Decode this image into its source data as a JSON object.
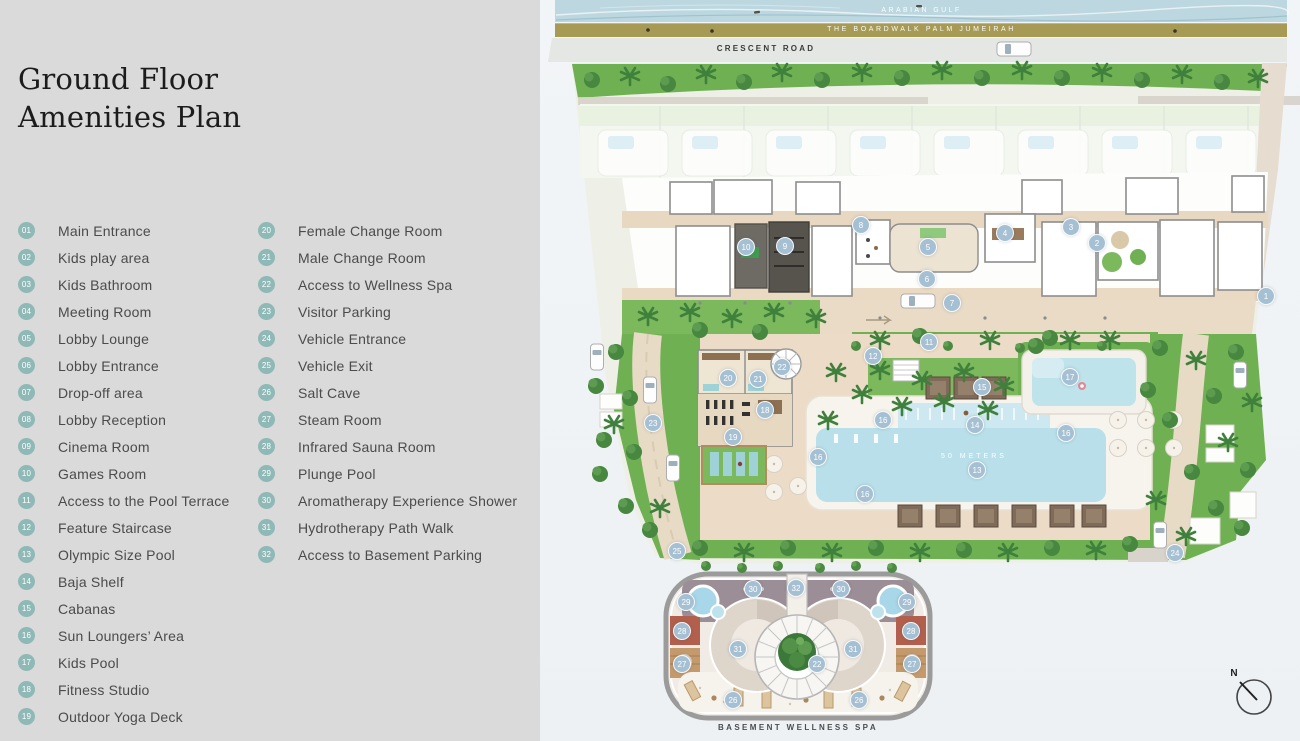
{
  "title": {
    "line1": "Ground Floor",
    "line2": "Amenities Plan"
  },
  "legend": {
    "column1": [
      {
        "num": "01",
        "label": "Main Entrance"
      },
      {
        "num": "02",
        "label": "Kids play area"
      },
      {
        "num": "03",
        "label": "Kids Bathroom"
      },
      {
        "num": "04",
        "label": "Meeting Room"
      },
      {
        "num": "05",
        "label": "Lobby Lounge"
      },
      {
        "num": "06",
        "label": "Lobby Entrance"
      },
      {
        "num": "07",
        "label": "Drop-off area"
      },
      {
        "num": "08",
        "label": "Lobby Reception"
      },
      {
        "num": "09",
        "label": "Cinema Room"
      },
      {
        "num": "10",
        "label": "Games Room"
      },
      {
        "num": "11",
        "label": "Access to the Pool Terrace"
      },
      {
        "num": "12",
        "label": "Feature Staircase"
      },
      {
        "num": "13",
        "label": "Olympic Size Pool"
      },
      {
        "num": "14",
        "label": "Baja Shelf"
      },
      {
        "num": "15",
        "label": "Cabanas"
      },
      {
        "num": "16",
        "label": "Sun Loungers’ Area"
      },
      {
        "num": "17",
        "label": "Kids Pool"
      },
      {
        "num": "18",
        "label": "Fitness Studio"
      },
      {
        "num": "19",
        "label": "Outdoor Yoga Deck"
      }
    ],
    "column2": [
      {
        "num": "20",
        "label": "Female Change Room"
      },
      {
        "num": "21",
        "label": "Male Change Room"
      },
      {
        "num": "22",
        "label": "Access to Wellness Spa"
      },
      {
        "num": "23",
        "label": "Visitor Parking"
      },
      {
        "num": "24",
        "label": "Vehicle Entrance"
      },
      {
        "num": "25",
        "label": "Vehicle Exit"
      },
      {
        "num": "26",
        "label": "Salt Cave"
      },
      {
        "num": "27",
        "label": "Steam Room"
      },
      {
        "num": "28",
        "label": "Infrared Sauna Room"
      },
      {
        "num": "29",
        "label": "Plunge Pool"
      },
      {
        "num": "30",
        "label": "Aromatherapy Experience Shower"
      },
      {
        "num": "31",
        "label": "Hydrotherapy Path Walk"
      },
      {
        "num": "32",
        "label": "Access to Basement Parking"
      }
    ]
  },
  "map": {
    "labels": {
      "gulf": "ARABIAN GULF",
      "boardwalk": "THE BOARDWALK PALM JUMEIRAH",
      "road": "CRESCENT ROAD",
      "pool": "50 METERS",
      "spa": "BASEMENT WELLNESS SPA",
      "compass": "N"
    },
    "markers": [
      {
        "n": "1",
        "x": 1266,
        "y": 296
      },
      {
        "n": "2",
        "x": 1097,
        "y": 243
      },
      {
        "n": "3",
        "x": 1071,
        "y": 227
      },
      {
        "n": "4",
        "x": 1005,
        "y": 233
      },
      {
        "n": "5",
        "x": 928,
        "y": 247
      },
      {
        "n": "6",
        "x": 927,
        "y": 279
      },
      {
        "n": "7",
        "x": 952,
        "y": 303
      },
      {
        "n": "8",
        "x": 861,
        "y": 225
      },
      {
        "n": "9",
        "x": 785,
        "y": 246
      },
      {
        "n": "10",
        "x": 746,
        "y": 247
      },
      {
        "n": "11",
        "x": 929,
        "y": 342
      },
      {
        "n": "12",
        "x": 873,
        "y": 356
      },
      {
        "n": "13",
        "x": 977,
        "y": 470
      },
      {
        "n": "14",
        "x": 975,
        "y": 425
      },
      {
        "n": "15",
        "x": 982,
        "y": 387
      },
      {
        "n": "16",
        "x": 883,
        "y": 420
      },
      {
        "n": "16",
        "x": 818,
        "y": 457
      },
      {
        "n": "16",
        "x": 1066,
        "y": 433
      },
      {
        "n": "16",
        "x": 865,
        "y": 494
      },
      {
        "n": "17",
        "x": 1070,
        "y": 377
      },
      {
        "n": "18",
        "x": 765,
        "y": 410
      },
      {
        "n": "19",
        "x": 733,
        "y": 437
      },
      {
        "n": "20",
        "x": 728,
        "y": 378
      },
      {
        "n": "21",
        "x": 758,
        "y": 379
      },
      {
        "n": "22",
        "x": 782,
        "y": 367
      },
      {
        "n": "23",
        "x": 653,
        "y": 423
      },
      {
        "n": "24",
        "x": 1175,
        "y": 553
      },
      {
        "n": "25",
        "x": 677,
        "y": 551
      },
      {
        "n": "26",
        "x": 733,
        "y": 700
      },
      {
        "n": "26",
        "x": 859,
        "y": 700
      },
      {
        "n": "27",
        "x": 682,
        "y": 664
      },
      {
        "n": "27",
        "x": 912,
        "y": 664
      },
      {
        "n": "28",
        "x": 682,
        "y": 631
      },
      {
        "n": "28",
        "x": 911,
        "y": 631
      },
      {
        "n": "29",
        "x": 686,
        "y": 602
      },
      {
        "n": "29",
        "x": 907,
        "y": 602
      },
      {
        "n": "30",
        "x": 753,
        "y": 589
      },
      {
        "n": "30",
        "x": 841,
        "y": 589
      },
      {
        "n": "31",
        "x": 738,
        "y": 649
      },
      {
        "n": "31",
        "x": 853,
        "y": 649
      },
      {
        "n": "32",
        "x": 796,
        "y": 588
      },
      {
        "n": "22",
        "x": 817,
        "y": 664
      }
    ]
  },
  "colors": {
    "panel_gray": "#d9dad9",
    "legend_teal": "#8fb9b6",
    "marker_blue": "#a6c0d3",
    "water": "#bcd7e0",
    "boardwalk": "#a69a55",
    "road": "#e4e7e3",
    "lawn": "#6fb152",
    "paving": "#ecdcc7",
    "pool": "#b9e0ea"
  }
}
